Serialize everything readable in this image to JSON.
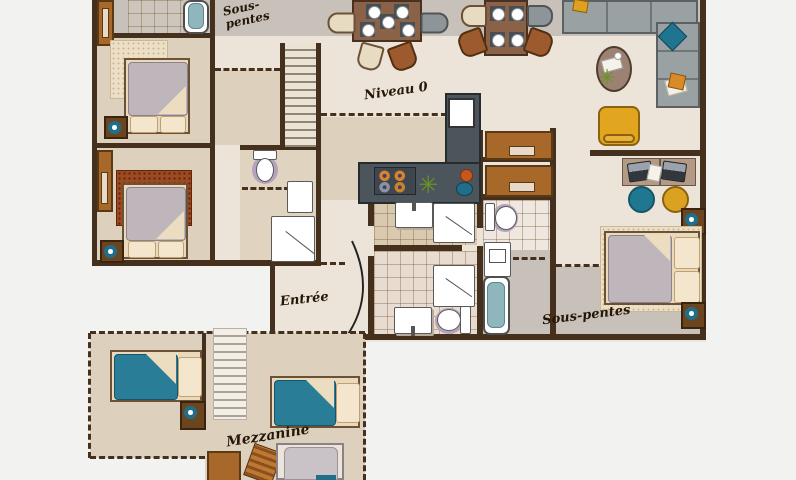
{
  "labels": {
    "sous_pentes_top_line1": "Sous-",
    "sous_pentes_top_line2": "pentes",
    "niveau": "Niveau 0",
    "entree": "Entrée",
    "sous_pentes_right": "Sous-pentes",
    "mezzanine": "Mezzanine"
  },
  "icons": {
    "plant": "✳"
  },
  "colors": {
    "background": "#f2f2f1",
    "floor_beige": "#ece4d8",
    "room_tan": "#ddd0bc",
    "sous_pentes_gray": "#c8c1b9",
    "wall_brown": "#45301e",
    "kitchen_counter": "#4c545c",
    "accent_teal": "#2a7d97",
    "accent_yellow": "#e2a51f",
    "rug_red": "#9c4a20",
    "label_ink": "#241708"
  }
}
